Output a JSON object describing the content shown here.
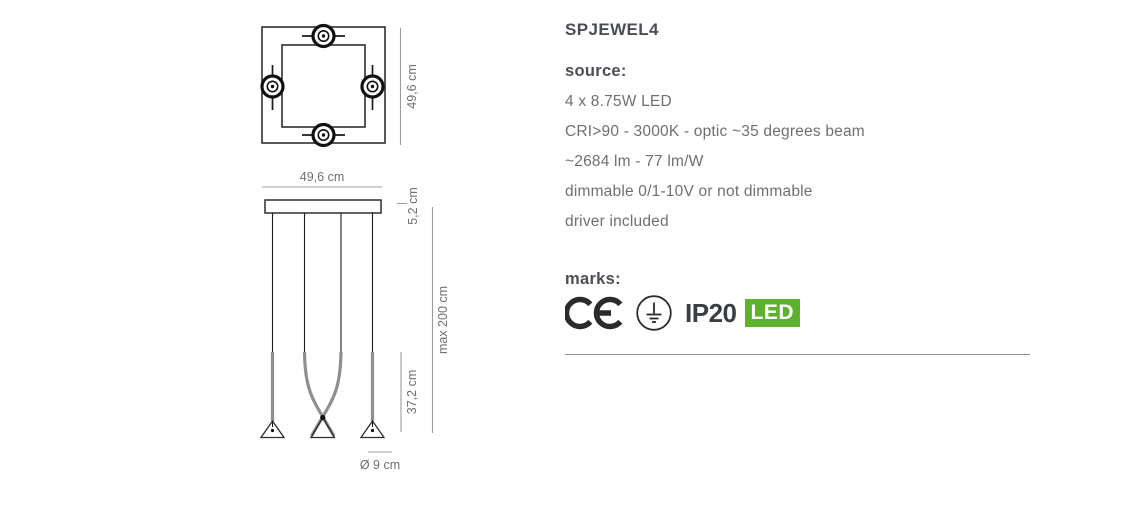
{
  "product": {
    "title": "SPJEWEL4",
    "source_heading": "source:",
    "specs": [
      "4 x 8.75W LED",
      "CRI>90 - 3000K - optic ~35 degrees beam",
      "~2684 lm - 77 lm/W",
      "dimmable 0/1-10V or not dimmable",
      "driver included"
    ],
    "marks_heading": "marks:",
    "marks": {
      "ce_icon": "ce-mark",
      "ground_icon": "protective-earth-class-I",
      "ip_rating": "IP20",
      "led_label": "LED"
    }
  },
  "diagram": {
    "top_view": {
      "description": "square-ceiling-frame-with-four-spot-connectors",
      "height_label": "49,6 cm"
    },
    "side_view": {
      "description": "four-cable-pendant-with-cone-diffusers",
      "width_label": "49,6 cm",
      "canopy_height_label": "5,2 cm",
      "max_suspension_label": "max 200 cm",
      "diffuser_height_label": "37,2 cm",
      "diffuser_diameter_label": "Ø 9 cm"
    }
  },
  "colors": {
    "heading_text": "#4a4e54",
    "body_text": "#6f6f6f",
    "drawing_line": "#2e2e2e",
    "dimension_line": "#9b9b9b",
    "led_badge_green": "#5cb12d",
    "led_badge_text": "#ffffff"
  }
}
